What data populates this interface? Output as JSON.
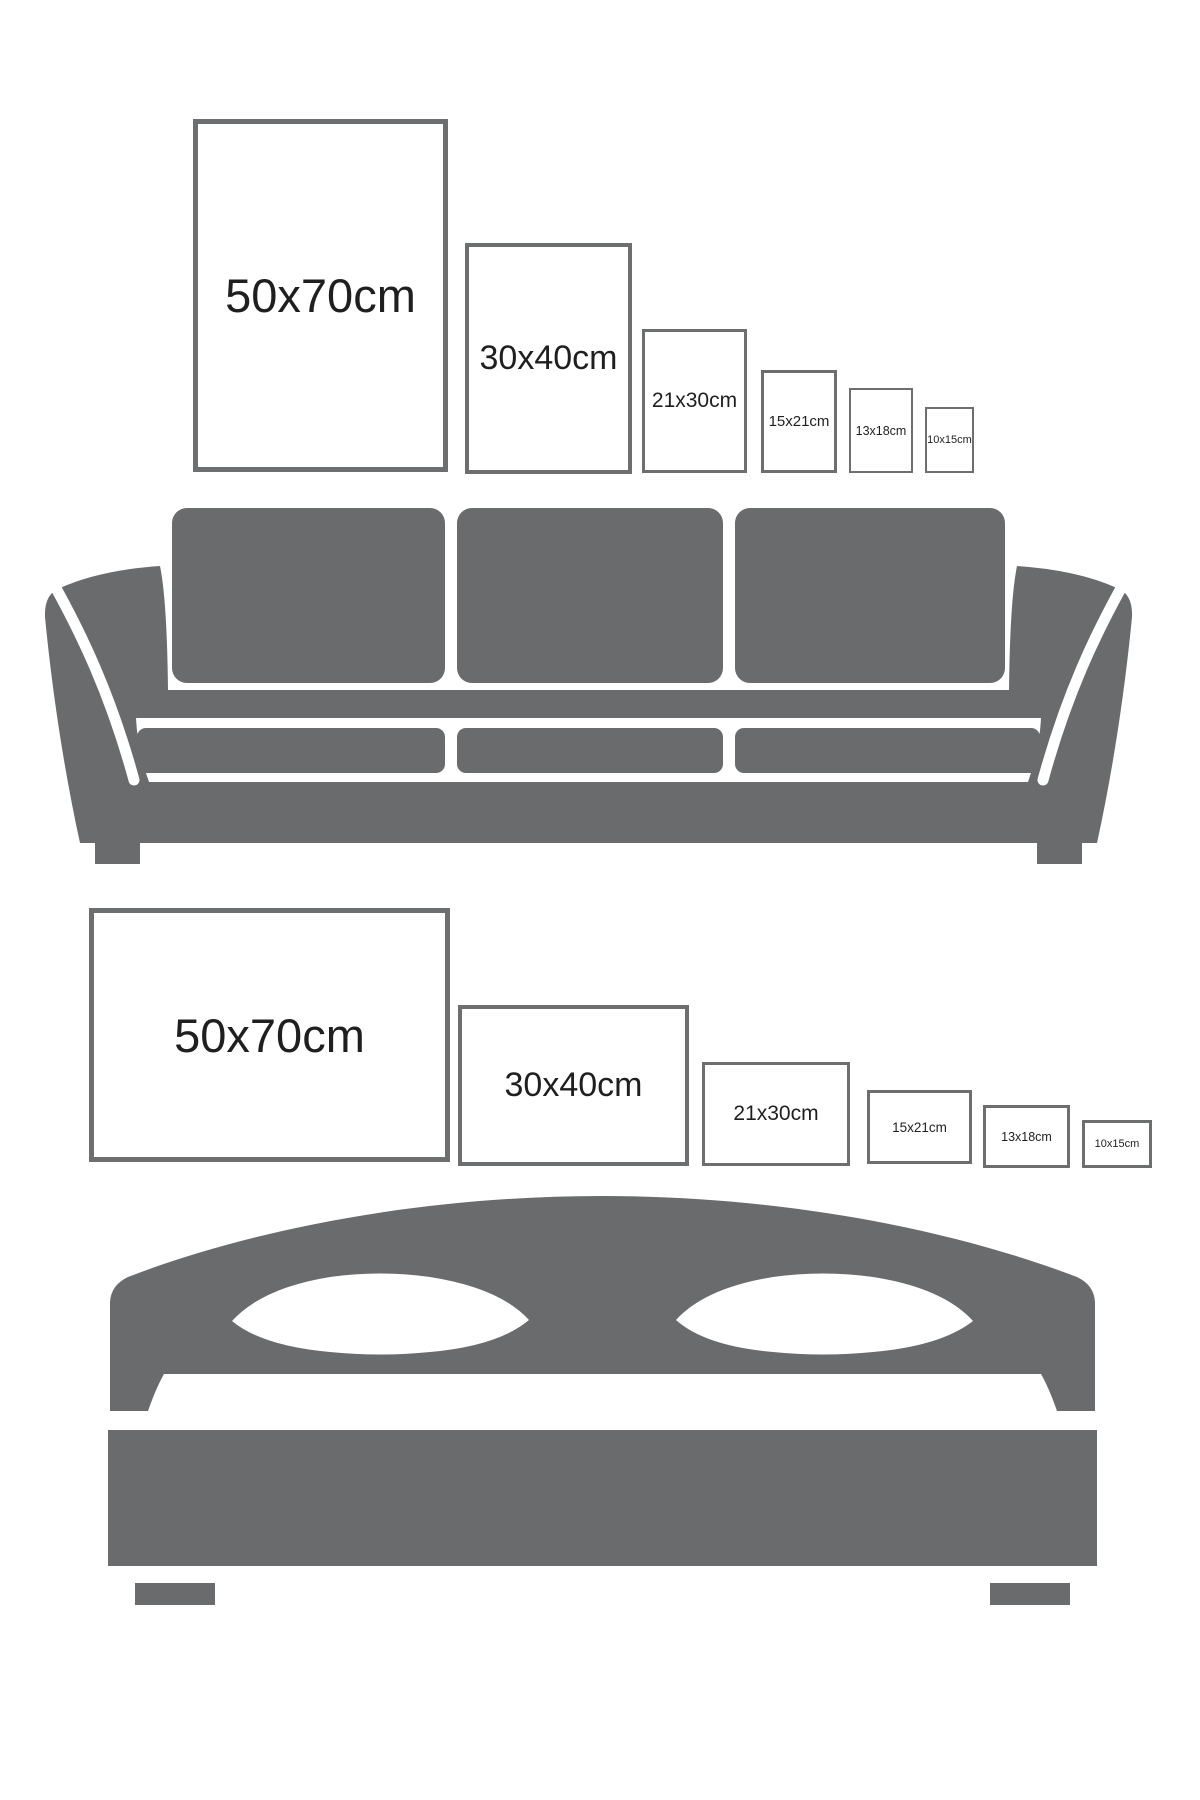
{
  "colors": {
    "silhouette": "#6a6b6d",
    "frame_border": "#6d6e70",
    "label": "#1f1f1f",
    "background": "#ffffff",
    "cutout": "#ffffff"
  },
  "portrait_section": {
    "furniture_icon": "sofa-icon",
    "frames": [
      {
        "label": "50x70cm"
      },
      {
        "label": "30x40cm"
      },
      {
        "label": "21x30cm"
      },
      {
        "label": "15x21cm"
      },
      {
        "label": "13x18cm"
      },
      {
        "label": "10x15cm"
      }
    ]
  },
  "landscape_section": {
    "furniture_icon": "bed-icon",
    "frames": [
      {
        "label": "50x70cm"
      },
      {
        "label": "30x40cm"
      },
      {
        "label": "21x30cm"
      },
      {
        "label": "15x21cm"
      },
      {
        "label": "13x18cm"
      },
      {
        "label": "10x15cm"
      }
    ]
  }
}
